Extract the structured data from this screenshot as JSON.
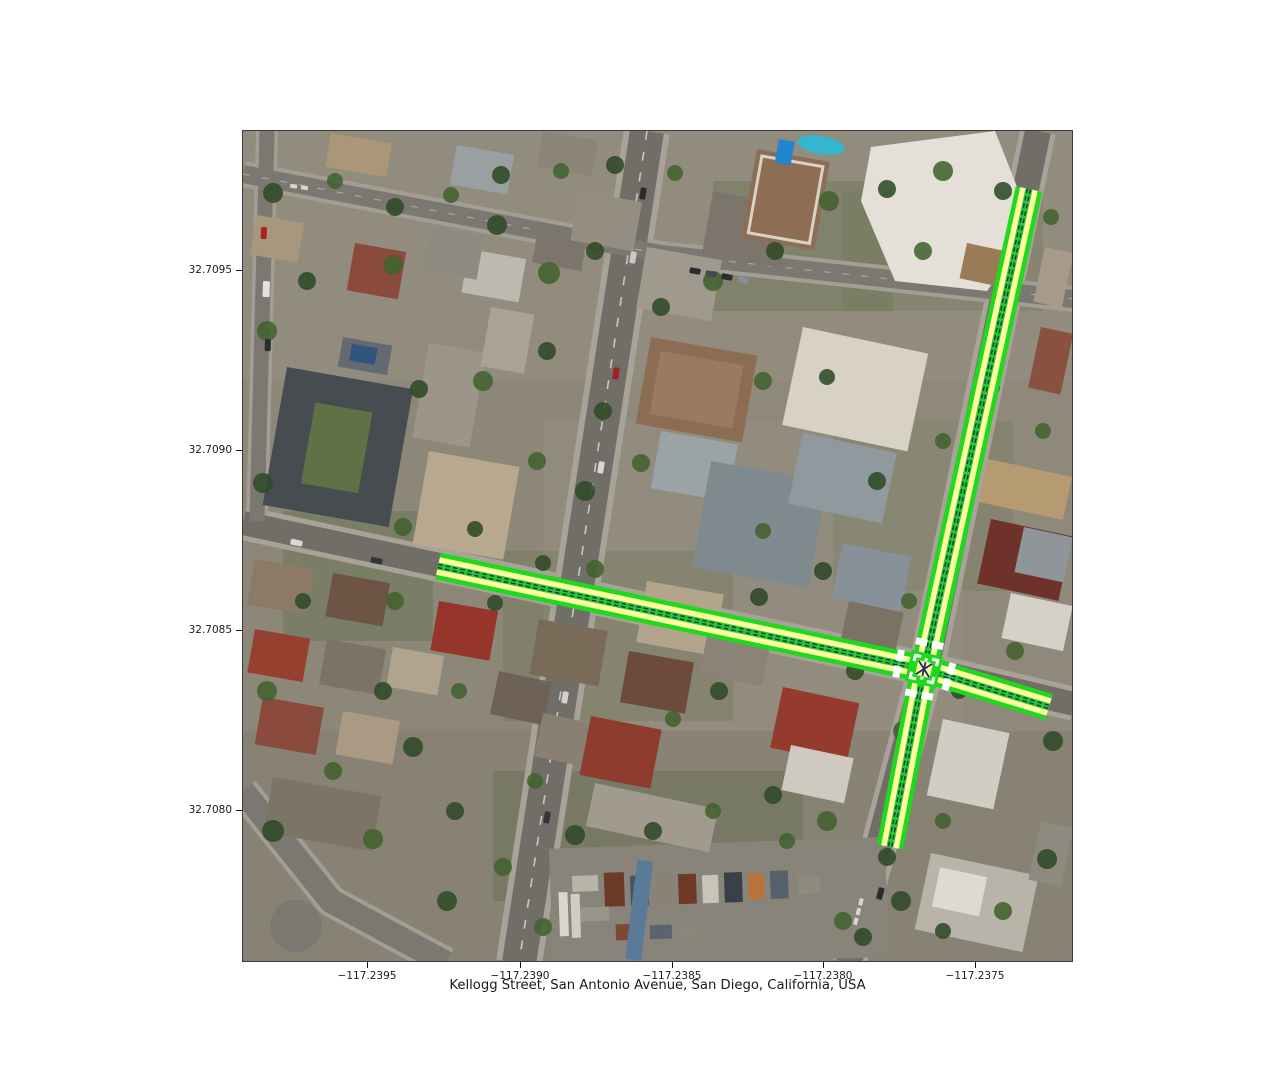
{
  "figure": {
    "xlabel": "Kellogg Street, San Antonio Avenue, San Diego, California, USA",
    "axes_px": {
      "left": 242,
      "top": 130,
      "width": 831,
      "height": 832
    },
    "x_ticks": [
      {
        "label": "−117.2395",
        "px": 367
      },
      {
        "label": "−117.2390",
        "px": 520
      },
      {
        "label": "−117.2385",
        "px": 672
      },
      {
        "label": "−117.2380",
        "px": 823
      },
      {
        "label": "−117.2375",
        "px": 975
      }
    ],
    "y_ticks": [
      {
        "label": "32.7095",
        "px": 270
      },
      {
        "label": "32.7090",
        "px": 450
      },
      {
        "label": "32.7085",
        "px": 630
      },
      {
        "label": "32.7080",
        "px": 810
      }
    ]
  },
  "map": {
    "type": "satellite-with-road-network-overlay",
    "location": "Kellogg Street, San Antonio Avenue, San Diego, California, USA",
    "intersection_px": [
      923,
      668
    ],
    "highlighted_roads": [
      {
        "name": "San Antonio Avenue",
        "points_px": [
          [
            1028,
            188
          ],
          [
            923,
            668
          ],
          [
            889,
            846
          ]
        ]
      },
      {
        "name": "Kellogg Street",
        "points_px": [
          [
            437,
            565
          ],
          [
            923,
            668
          ],
          [
            1048,
            706
          ]
        ]
      }
    ],
    "overlay_style": {
      "edge_color": "#1fd91f",
      "lane_color": "#fdfda0",
      "median_color": "#22cc22",
      "centerline_color": "#252570",
      "crosswalk_color": "#ffffff",
      "edge_width": 27,
      "lane_width": 18,
      "median_width": 7,
      "centerline_width": 4.5,
      "crosswalk_offset": 26
    }
  }
}
